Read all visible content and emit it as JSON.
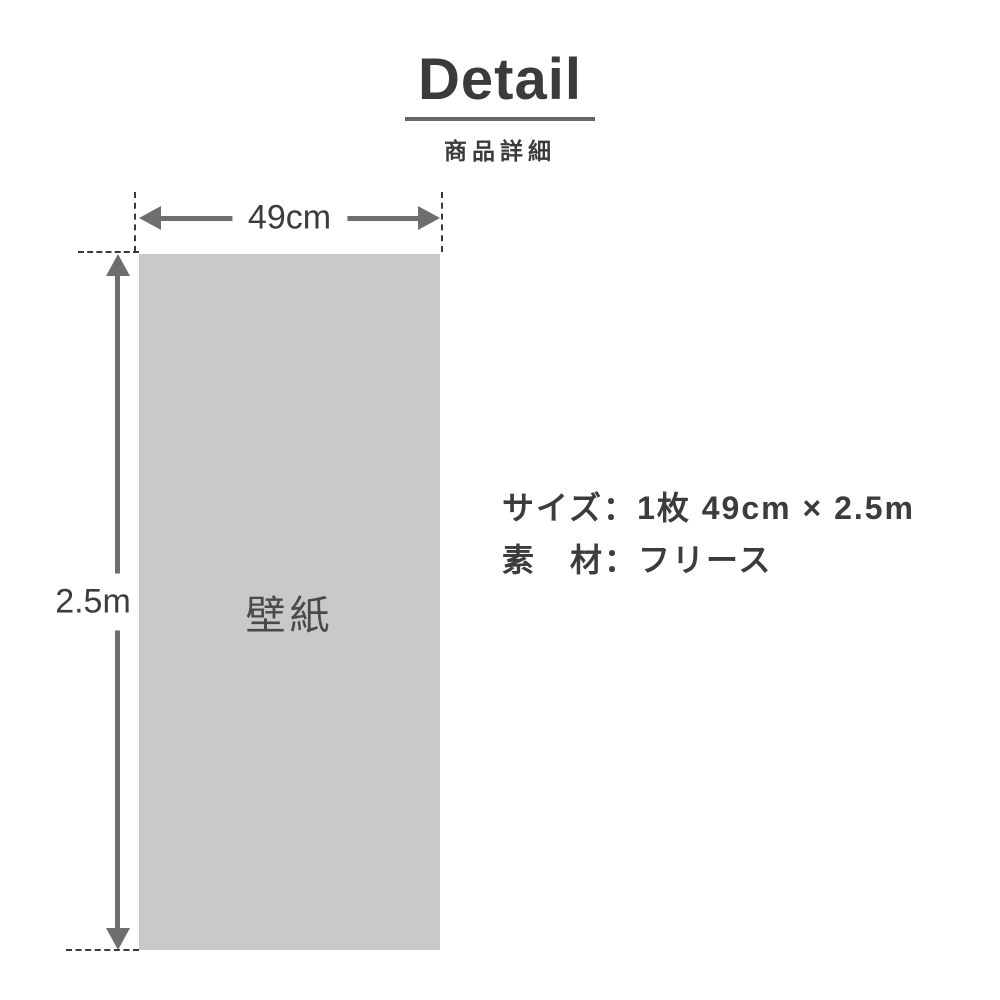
{
  "header": {
    "title": "Detail",
    "subtitle": "商品詳細"
  },
  "diagram": {
    "panel_label": "壁紙",
    "width_label": "49cm",
    "height_label": "2.5m"
  },
  "specs": {
    "colon": "：",
    "rows": [
      {
        "label": "サイズ",
        "value": "1枚 49cm × 2.5m"
      },
      {
        "label": "素　材",
        "value": "フリース"
      }
    ]
  },
  "colors": {
    "title_text": "#3b3b3b",
    "underline": "#666666",
    "arrow_gray": "#6e6e6e",
    "dash_gray": "#3a3a3a",
    "panel_fill": "#c9c9c9",
    "panel_text": "#4a4a4a",
    "background": "#ffffff"
  }
}
